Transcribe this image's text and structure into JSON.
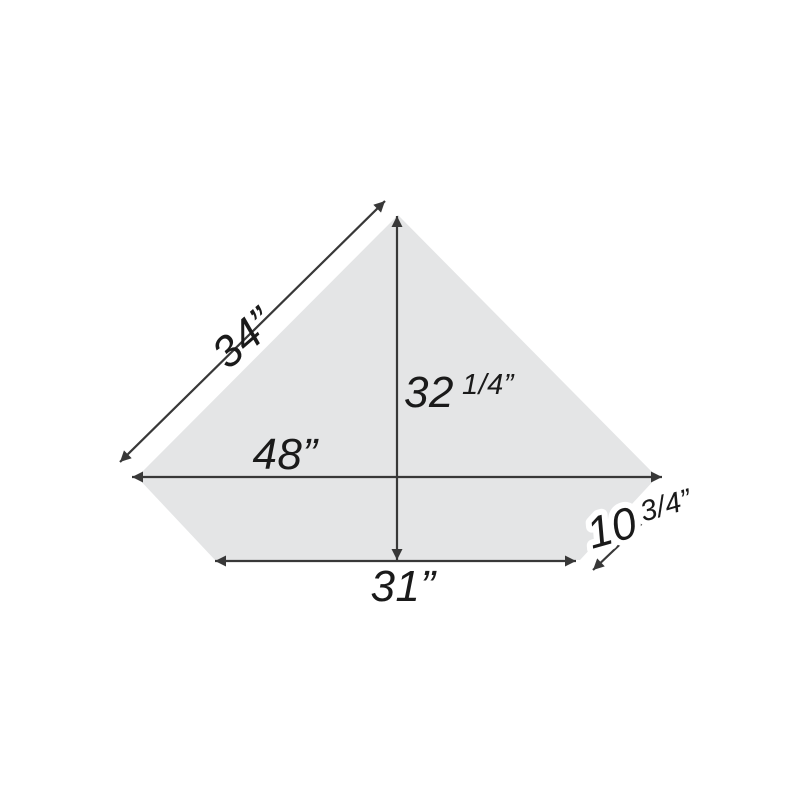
{
  "diagram": {
    "title": "corner-desk-top-dimension-diagram",
    "colors": {
      "background": "#ffffff",
      "shape_fill": "#e4e5e6",
      "line": "#383838",
      "text": "#1a1a1a"
    },
    "labels": {
      "top_left_edge": {
        "value": "34”"
      },
      "vertical": {
        "value": "32",
        "fraction": "1/4”"
      },
      "horizontal": {
        "value": "48”"
      },
      "bottom": {
        "value": "31”"
      },
      "bottom_right_edge": {
        "value": "10",
        "fraction": "3/4”"
      }
    }
  }
}
